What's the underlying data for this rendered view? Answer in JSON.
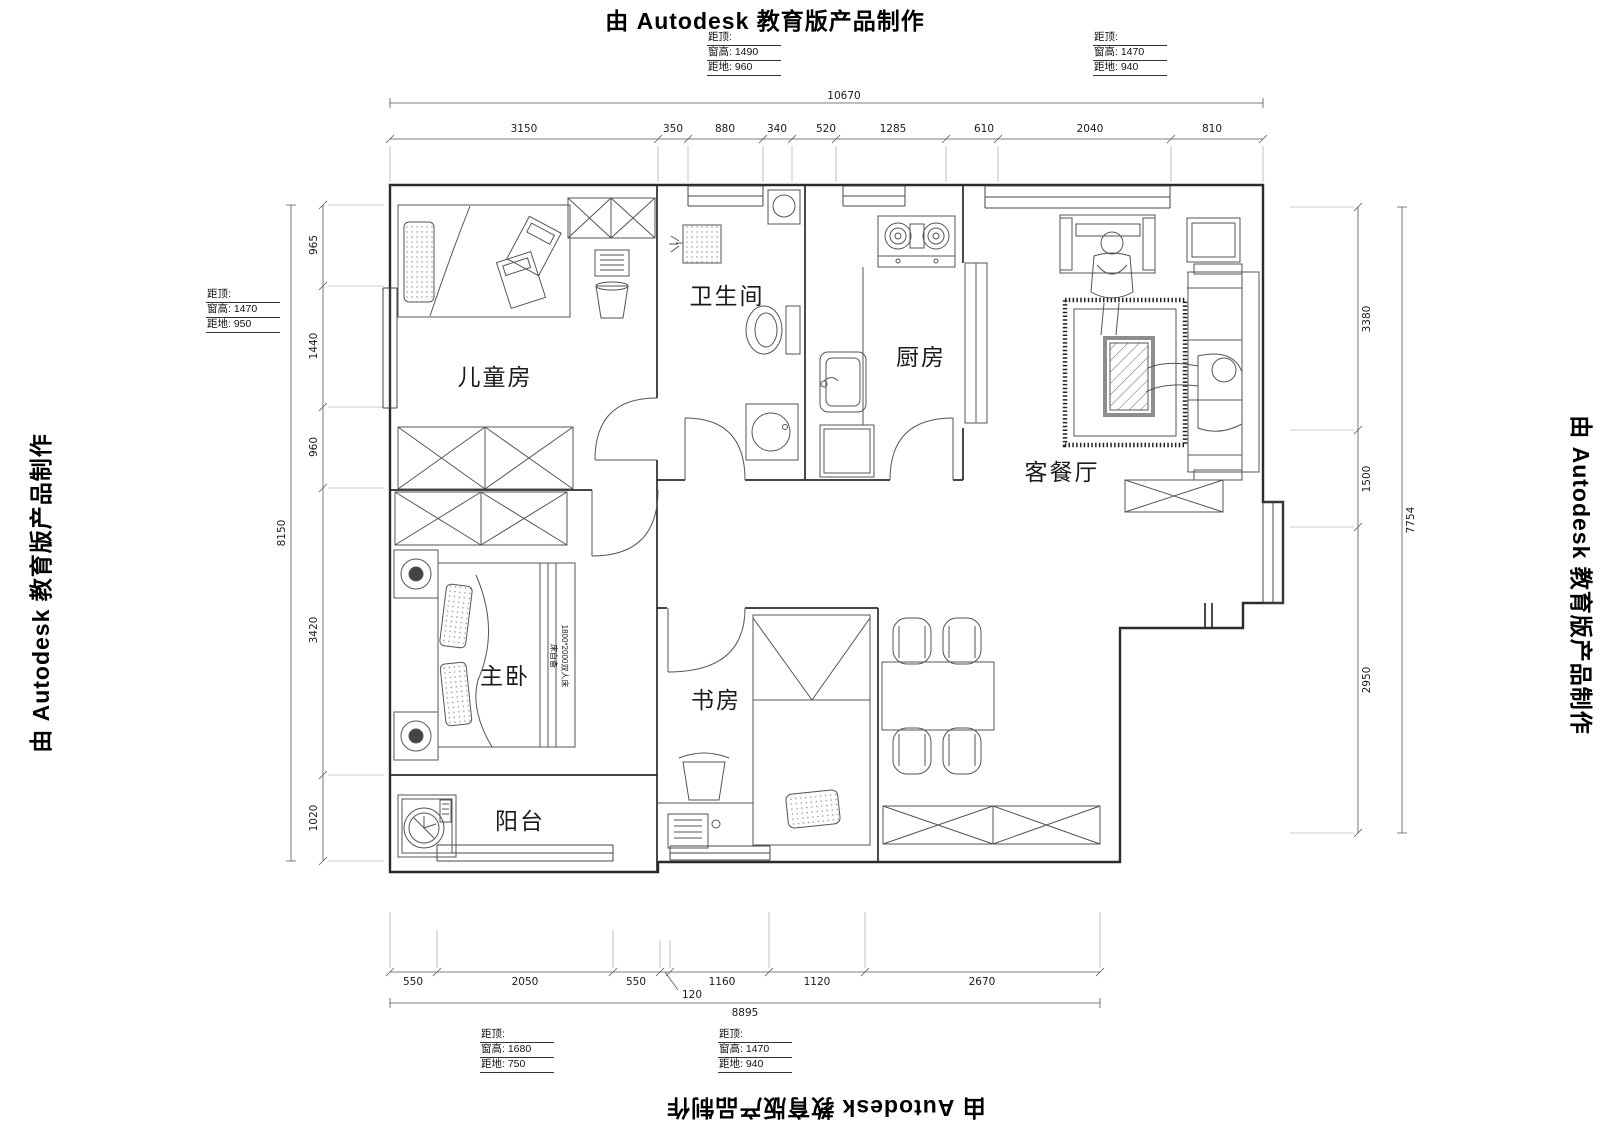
{
  "watermark": "由 Autodesk 教育版产品制作",
  "annotations": {
    "top_left": {
      "row1": "距顶:",
      "row2": "窗高: 1490",
      "row3": "距地: 960"
    },
    "top_right": {
      "row1": "距顶:",
      "row2": "窗高: 1470",
      "row3": "距地: 940"
    },
    "left": {
      "row1": "距顶:",
      "row2": "窗高: 1470",
      "row3": "距地: 950"
    },
    "bottom_left": {
      "row1": "距顶:",
      "row2": "窗高: 1680",
      "row3": "距地: 750"
    },
    "bottom_mid": {
      "row1": "距顶:",
      "row2": "窗高: 1470",
      "row3": "距地: 940"
    }
  },
  "dimensions": {
    "top": {
      "overall": "10670",
      "segments": [
        "3150",
        "350",
        "880",
        "340",
        "520",
        "1285",
        "610",
        "2040",
        "810"
      ]
    },
    "left": {
      "overall": "8150",
      "segments": [
        "965",
        "1440",
        "960",
        "3420",
        "1020"
      ]
    },
    "right": {
      "overall": "7754",
      "segments": [
        "3380",
        "1500",
        "2950"
      ]
    },
    "bottom": {
      "overall": "8895",
      "segments": [
        "550",
        "2050",
        "550",
        "120",
        "1160",
        "1120",
        "2670"
      ]
    }
  },
  "rooms": {
    "children": "儿童房",
    "bath": "卫生间",
    "kitchen": "厨房",
    "living": "客餐厅",
    "master": "主卧",
    "study": "书房",
    "balcony": "阳台"
  },
  "bed_note": {
    "line1": "床自备",
    "line2": "1800*2000双人床"
  }
}
